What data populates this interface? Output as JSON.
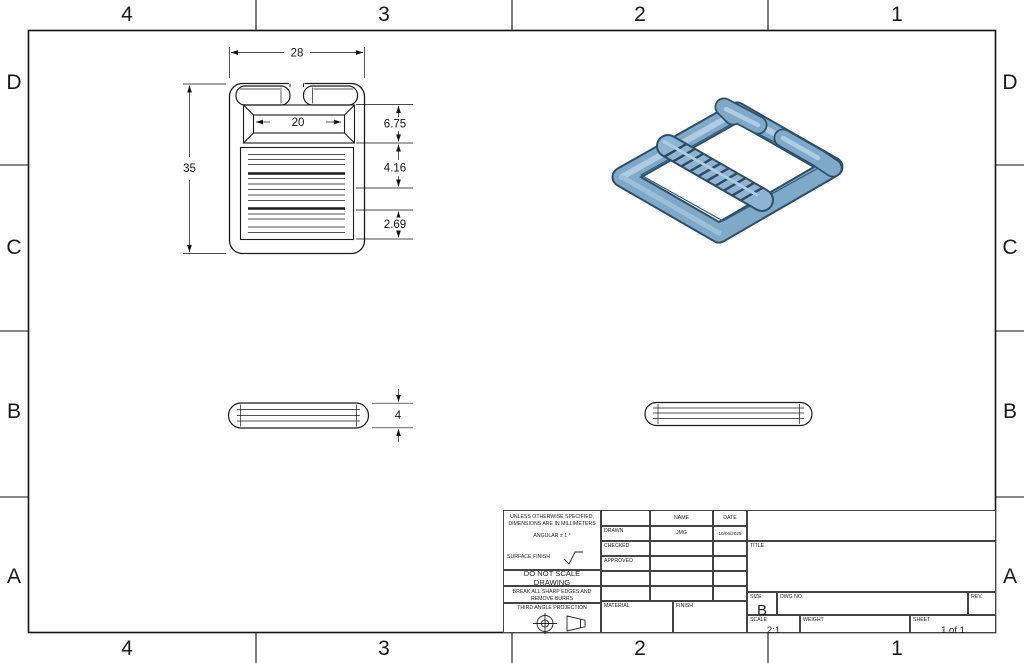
{
  "sheet": {
    "zones_top": [
      "4",
      "3",
      "2",
      "1"
    ],
    "zones_bottom": [
      "4",
      "3",
      "2",
      "1"
    ],
    "zones_left": [
      "D",
      "C",
      "B",
      "A"
    ],
    "zones_right": [
      "D",
      "C",
      "B",
      "A"
    ]
  },
  "dims": {
    "front_width": "28",
    "front_inner_width": "20",
    "front_height": "35",
    "right_d1": "6.75",
    "right_d2": "4.16",
    "right_d3": "2.69",
    "side_thickness": "4"
  },
  "title_block": {
    "spec_line1": "UNLESS OTHERWISE SPECIFIED,",
    "spec_line2": "DIMENSIONS ARE IN MILLIMETERS",
    "angular": "ANGULAR ± 1 °",
    "surface_finish_label": "SURFACE FINISH",
    "do_not_scale": "DO NOT SCALE DRAWING",
    "break_edges_line1": "BREAK ALL SHARP EDGES AND",
    "break_edges_line2": "REMOVE BURRS",
    "projection_label": "THIRD ANGLE PROJECTION",
    "col_name": "NAME",
    "col_date": "DATE",
    "row_drawn": "DRAWN",
    "row_checked": "CHECKED",
    "row_approved": "APPROVED",
    "drawn_name": "JMG",
    "drawn_date": "10/06/2025",
    "material_label": "MATERIAL",
    "finish_label": "FINISH",
    "title_label": "TITLE",
    "size_label": "SIZE",
    "size_value": "B",
    "dwg_no_label": "DWG NO.",
    "rev_label": "REV.",
    "scale_label": "SCALE",
    "scale_value": "2:1",
    "weight_label": "WEIGHT",
    "sheet_label": "SHEET",
    "sheet_value": "1 of 1"
  },
  "colors": {
    "partMain": "#7fa9c9",
    "partLight": "#aecde2",
    "partDark": "#46718f",
    "partOutline": "#2c4f6b",
    "ribDark": "#2e4a60",
    "lineColor": "#1a1a1a"
  }
}
